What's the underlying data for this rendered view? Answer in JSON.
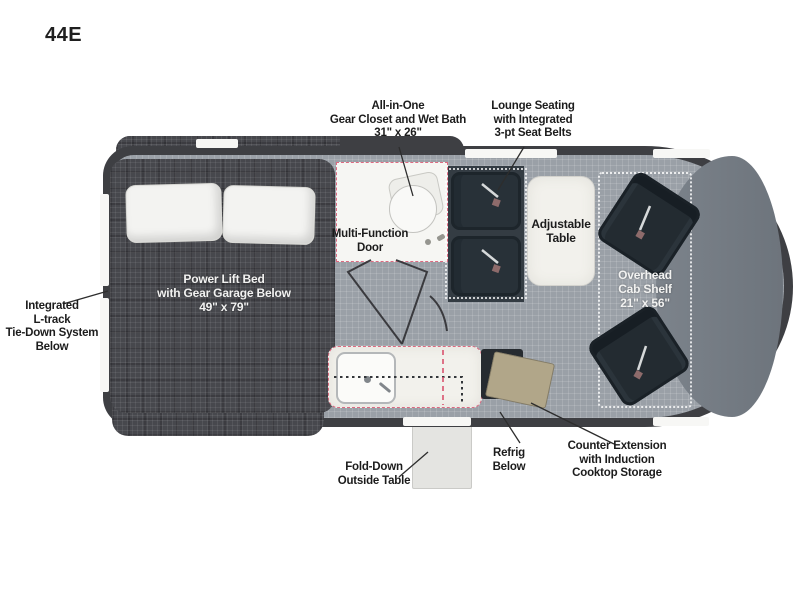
{
  "model": "44E",
  "callouts": {
    "gear_closet": [
      "All-in-One",
      "Gear Closet and Wet Bath",
      "31\" x 26\""
    ],
    "lounge": [
      "Lounge Seating",
      "with Integrated",
      "3-pt Seat Belts"
    ],
    "ltrack": [
      "Integrated",
      "L-track",
      "Tie-Down System",
      "Below"
    ],
    "multi_door": [
      "Multi-Function",
      "Door"
    ],
    "adjustable_table": [
      "Adjustable",
      "Table"
    ],
    "bed": [
      "Power Lift Bed",
      "with Gear Garage Below",
      "49\" x 79\""
    ],
    "cab_shelf": [
      "Overhead",
      "Cab Shelf",
      "21\" x 56\""
    ],
    "fold_table": [
      "Fold-Down",
      "Outside Table"
    ],
    "refrig": [
      "Refrig",
      "Below"
    ],
    "counter_ext": [
      "Counter Extension",
      "with Induction",
      "Cooktop Storage"
    ]
  },
  "colors": {
    "wall": "#3e3f43",
    "floor": "#9aa0a7",
    "bed_plaid": "#47484d",
    "seat": "#283138",
    "accent_dashed_pink": "#d9526e",
    "table_white": "#f2f1ec",
    "flap_tan": "#b1a689",
    "dash_gray": "#7c838b"
  }
}
